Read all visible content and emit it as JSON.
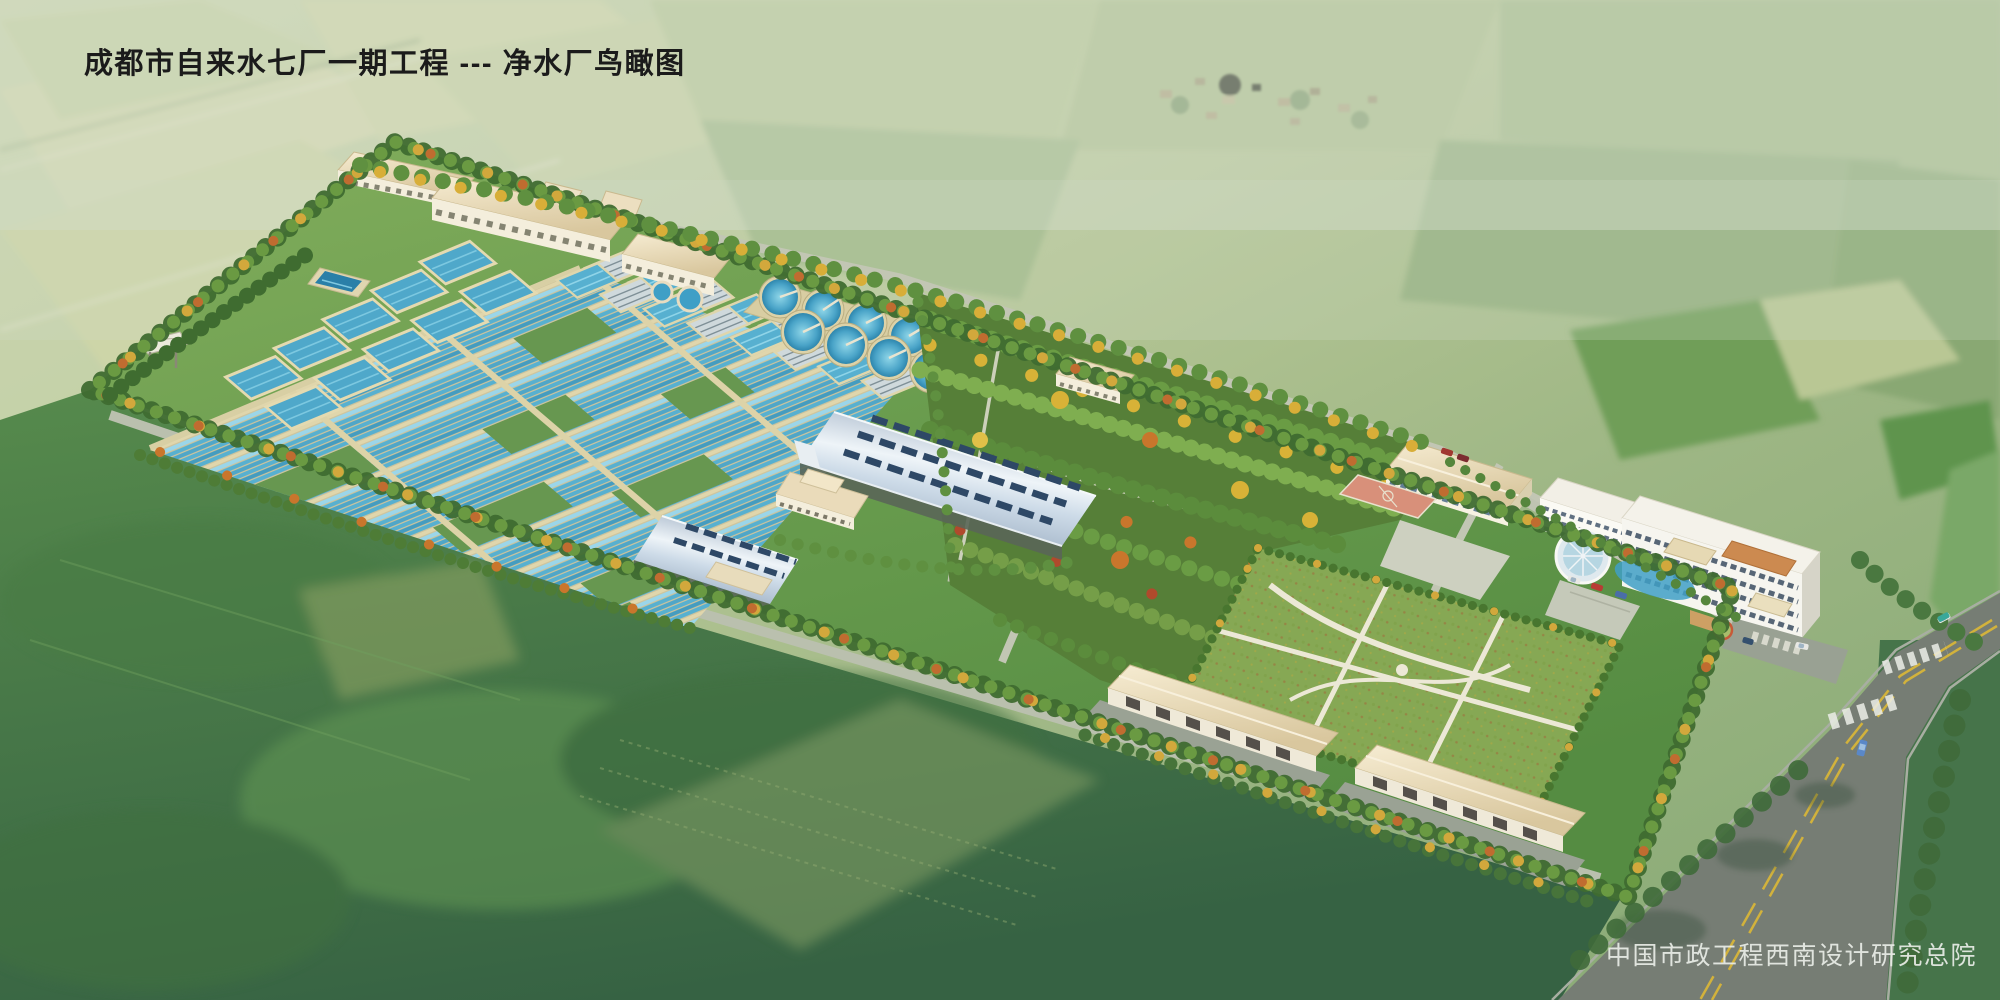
{
  "title": {
    "text": "成都市自来水七厂一期工程 --- 净水厂鸟瞰图"
  },
  "credit": {
    "text": "中国市政工程西南设计研究总院"
  },
  "palette": {
    "title_color": "#1b1b1b",
    "credit_color": "#e9ede7",
    "basin_water_blue": "#4fa6c8",
    "clarifier_blue": "#3f9fc6",
    "roof_beige": "#ead9b8",
    "arch_roof_blue": "#b6c4d4",
    "site_grass_green": "#699c4e",
    "lawn_green": "#86a854",
    "autumn_yellow": "#d2a83c",
    "autumn_orange": "#c06c30",
    "road_gray": "#767d74",
    "road_line_yellow": "#d2b23c"
  }
}
